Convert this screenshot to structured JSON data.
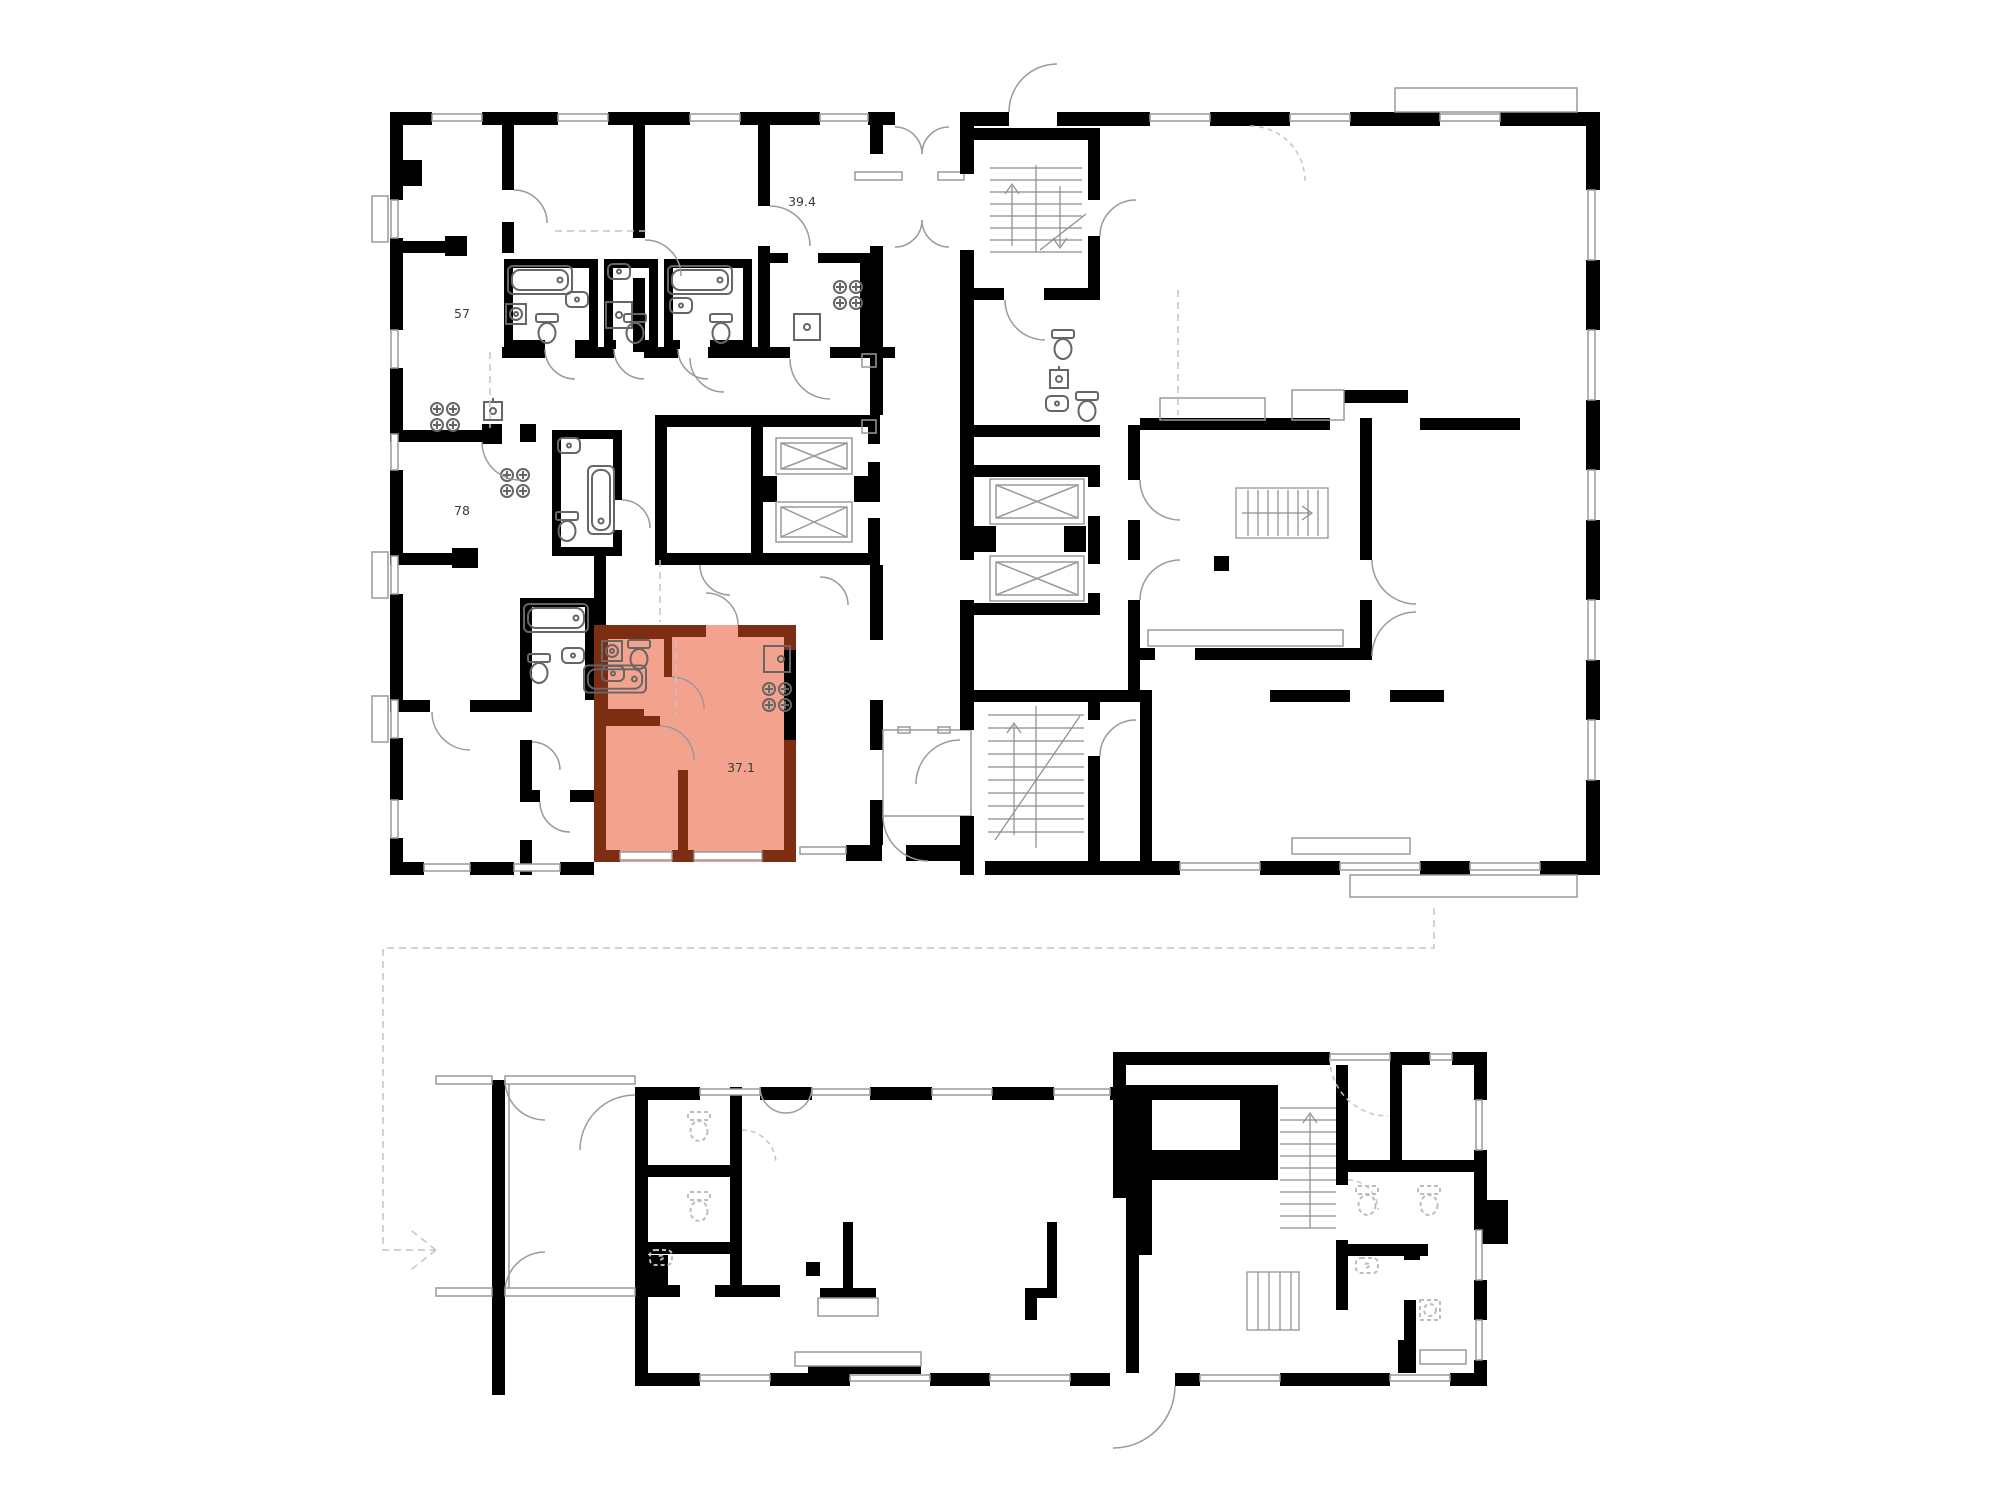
{
  "page": {
    "type": "architectural-floor-plan",
    "background": "#ffffff",
    "description": "Building floor plan with one highlighted apartment and a ground-floor plan below"
  },
  "colors": {
    "wall": "#000000",
    "highlight_fill": "#f3a28e",
    "highlight_wall": "#7c2d12",
    "fixture": "#666666",
    "thin_line": "#9a9a9a",
    "dashed_line": "#c4c4c4",
    "label": "#3d3d3d"
  },
  "upper_plan": {
    "name": "typical-floor-plan",
    "units": [
      {
        "id": "unit-57",
        "area_label": "57",
        "highlighted": false
      },
      {
        "id": "unit-78",
        "area_label": "78",
        "highlighted": false
      },
      {
        "id": "unit-39-4",
        "area_label": "39.4",
        "highlighted": false
      },
      {
        "id": "unit-37-1",
        "area_label": "37.1",
        "highlighted": true
      }
    ]
  },
  "lower_plan": {
    "name": "ground-floor-plan",
    "units": []
  }
}
